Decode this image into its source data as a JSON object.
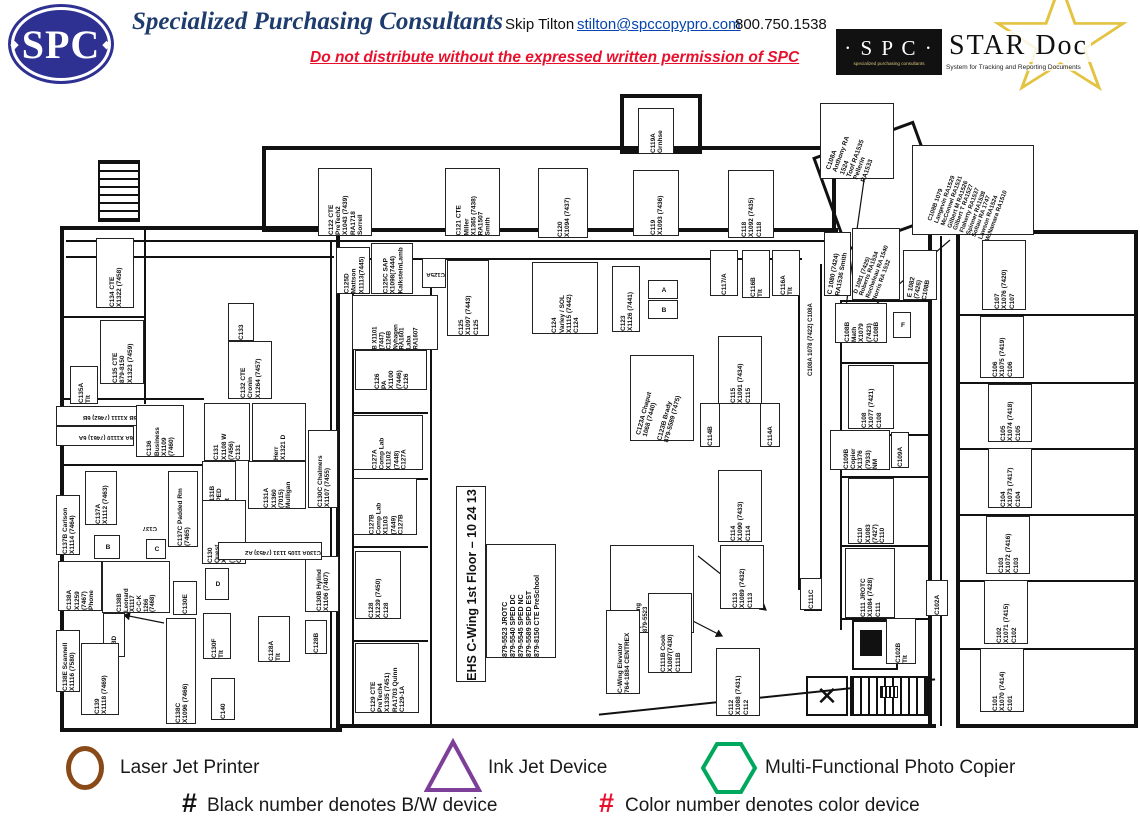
{
  "header": {
    "logo": "SPC",
    "company": "Specialized Purchasing Consultants",
    "contact": "Skip Tilton",
    "email": "stilton@spccopypro.com",
    "phone": "800.750.1538",
    "notice": "Do not distribute without the expressed written permission of SPC",
    "stardoc": {
      "box": "· S P C ·",
      "box_sub": "specialized purchasing consultants",
      "name": "STAR Doc",
      "tagline": "System for Tracking and Reporting Documents"
    }
  },
  "plan": {
    "title": "EHS C-Wing 1st Floor – 10 24 13",
    "phones": "879-5523  JROTC\n879-5540  SPED DC\n879-5545  SPED NC\n879-5589  SPED EST\n879-8150  CTE PreSchool",
    "rooms": [
      {
        "id": "C122",
        "l": "C122 CTE\nPreTech2\nX1043 (7439)\nRA1718\nSorrell",
        "x": 318,
        "y": 168,
        "w": 54,
        "h": 68
      },
      {
        "id": "C121",
        "l": "C121 CTE\nMiller\nX1365 (7438)\nRA1507\nSmith",
        "x": 445,
        "y": 168,
        "w": 55,
        "h": 68
      },
      {
        "id": "C120",
        "l": "C120\nX1094 (7437)",
        "x": 538,
        "y": 168,
        "w": 50,
        "h": 70
      },
      {
        "id": "C119",
        "l": "C119\nX1093 (7436)",
        "x": 633,
        "y": 170,
        "w": 46,
        "h": 66
      },
      {
        "id": "C119A",
        "l": "C119A\nGrnhse",
        "x": 638,
        "y": 108,
        "w": 36,
        "h": 46
      },
      {
        "id": "C118",
        "l": "C118\nX1092 (7435)\nC118",
        "x": 728,
        "y": 170,
        "w": 46,
        "h": 68
      },
      {
        "id": "C125D",
        "l": "C125D\nMattson\nX1113(7445)",
        "x": 336,
        "y": 247,
        "w": 34,
        "h": 47
      },
      {
        "id": "C125C",
        "l": "C125C SAP\nX1098(7444)\nKalksteinLamb",
        "x": 371,
        "y": 243,
        "w": 42,
        "h": 51
      },
      {
        "id": "C125A",
        "l": "C125A",
        "x": 422,
        "y": 258,
        "w": 24,
        "h": 30,
        "r": 180,
        "fs": 6
      },
      {
        "id": "C125",
        "l": "C125\nX1097 (7443)\nC125",
        "x": 447,
        "y": 260,
        "w": 42,
        "h": 76
      },
      {
        "id": "C124",
        "l": "C124\nVarley / SOL\nX1115 (7442)\nC124",
        "x": 532,
        "y": 262,
        "w": 66,
        "h": 72
      },
      {
        "id": "C123",
        "l": "C123\nX1126 (7441)",
        "x": 612,
        "y": 266,
        "w": 28,
        "h": 66
      },
      {
        "id": "boxA",
        "l": "A",
        "x": 648,
        "y": 280,
        "w": 30,
        "h": 19,
        "r": 0
      },
      {
        "id": "boxB",
        "l": "B",
        "x": 648,
        "y": 300,
        "w": 30,
        "h": 19,
        "r": 0
      },
      {
        "id": "C117A",
        "l": "C117/A",
        "x": 710,
        "y": 250,
        "w": 28,
        "h": 46
      },
      {
        "id": "C116B",
        "l": "C116B\nTlt",
        "x": 742,
        "y": 250,
        "w": 28,
        "h": 48
      },
      {
        "id": "C116A",
        "l": "C116A\nTlt",
        "x": 772,
        "y": 250,
        "w": 28,
        "h": 46
      },
      {
        "id": "C108A-box",
        "l": "C108A\nAnthony RA\n1524\nToof RA1535\nPellerin\nRA1533",
        "x": 820,
        "y": 103,
        "w": 74,
        "h": 76,
        "r": -70
      },
      {
        "id": "C108B-list",
        "l": "C108B 1079\nLangevin RA1529\nMcConnel RA1531\nGilbert M RA1526\nGilbert T RA1527\nFlaherty RA1537\nSpinner RA1538\nSoltau RA 1747\nLawson RA1524\nMcNamara RA1510",
        "x": 912,
        "y": 145,
        "w": 122,
        "h": 90,
        "r": -70,
        "fs": 6
      },
      {
        "id": "C-1080",
        "l": "C 1080 (7424)\nRA1536 Smith",
        "x": 824,
        "y": 232,
        "w": 27,
        "h": 64,
        "r": -80
      },
      {
        "id": "D-1081",
        "l": "D 1081 (7425)\nRoberts RA1534\nRocheleau RA 1540\nNorris RA 1532",
        "x": 852,
        "y": 228,
        "w": 48,
        "h": 72,
        "r": -70,
        "fs": 6
      },
      {
        "id": "E-1082",
        "l": "E 1082\n(7426)\nC108B",
        "x": 903,
        "y": 250,
        "w": 34,
        "h": 50,
        "r": -80
      },
      {
        "id": "C108B-Math",
        "l": "C108B\nMath\nX1079\n(7423)\nC108B",
        "x": 835,
        "y": 303,
        "w": 52,
        "h": 40
      },
      {
        "id": "C108A-wall",
        "l": "C108A 1078 (7422) C108A",
        "x": 804,
        "y": 276,
        "w": 14,
        "h": 102,
        "nb": true,
        "fs": 6
      },
      {
        "id": "boxF",
        "l": "F",
        "x": 893,
        "y": 312,
        "w": 18,
        "h": 26,
        "r": 0
      },
      {
        "id": "C108",
        "l": "C108\nX1077 (7421)\nC108",
        "x": 848,
        "y": 365,
        "w": 46,
        "h": 64
      },
      {
        "id": "C109B",
        "l": "C109B\nCopier\nX1376\n(7933)\nNM",
        "x": 830,
        "y": 430,
        "w": 60,
        "h": 40
      },
      {
        "id": "C109A",
        "l": "C109A",
        "x": 891,
        "y": 432,
        "w": 18,
        "h": 36
      },
      {
        "id": "C110",
        "l": "C110\nX1083\n(7427)\nC110",
        "x": 848,
        "y": 478,
        "w": 46,
        "h": 66
      },
      {
        "id": "C111",
        "l": "C111 JROTC\nX1084 (7428)\nC111",
        "x": 845,
        "y": 548,
        "w": 50,
        "h": 70
      },
      {
        "id": "C111C",
        "l": "C111C",
        "x": 800,
        "y": 578,
        "w": 22,
        "h": 32
      },
      {
        "id": "C102A",
        "l": "C102A",
        "x": 926,
        "y": 580,
        "w": 22,
        "h": 36
      },
      {
        "id": "C102B",
        "l": "C102B\nTlt",
        "x": 886,
        "y": 618,
        "w": 30,
        "h": 46
      },
      {
        "id": "C112",
        "l": "C112\nX1088 (7431)\nC112",
        "x": 716,
        "y": 648,
        "w": 44,
        "h": 68
      },
      {
        "id": "C113",
        "l": "C113\nX1089 (7432)\nC113",
        "x": 720,
        "y": 545,
        "w": 44,
        "h": 64
      },
      {
        "id": "C114",
        "l": "C114\nX1090 (7433)\nC114",
        "x": 718,
        "y": 470,
        "w": 44,
        "h": 72
      },
      {
        "id": "C115",
        "l": "C115\nX1091 (7434)\nC115",
        "x": 718,
        "y": 336,
        "w": 44,
        "h": 68
      },
      {
        "id": "C114B",
        "l": "C114B",
        "x": 700,
        "y": 403,
        "w": 20,
        "h": 44
      },
      {
        "id": "C114A",
        "l": "C114A",
        "x": 760,
        "y": 403,
        "w": 20,
        "h": 44
      },
      {
        "id": "C123AB",
        "l": "C123A Chaput\n1068 (7440)\n\nC123B Brady\n879-5589 (7475)",
        "x": 630,
        "y": 355,
        "w": 64,
        "h": 86,
        "r": -75
      },
      {
        "id": "C111A",
        "l": "C111A\nSpaulding\n879-5523\nC111-1A\nStu Phone\n1086 (7429)\nC111A-2A",
        "x": 610,
        "y": 545,
        "w": 84,
        "h": 88,
        "fs": 6
      },
      {
        "id": "C111B",
        "l": "C111B Cook\nX1087(7430)\nC111B",
        "x": 648,
        "y": 593,
        "w": 44,
        "h": 80
      },
      {
        "id": "elevator",
        "l": "C-Wing Elevator\n764-1884 CENTREX",
        "x": 606,
        "y": 610,
        "w": 34,
        "h": 84
      },
      {
        "id": "title",
        "l": "EHS C-Wing 1st Floor – 10 24 13",
        "x": 456,
        "y": 486,
        "w": 30,
        "h": 196,
        "cls": "title"
      },
      {
        "id": "phones",
        "l": "879-5523  JROTC\n879-5540  SPED DC\n879-5545  SPED NC\n879-5589  SPED EST\n879-8150  CTE PreSchool",
        "x": 486,
        "y": 544,
        "w": 70,
        "h": 114,
        "fs": 7
      },
      {
        "id": "C126B",
        "l": "B X1101\n(7447)\nC126B\nNyhagen\nRA1601\nLaba\nRA1607",
        "x": 352,
        "y": 295,
        "w": 86,
        "h": 55,
        "fs": 6
      },
      {
        "id": "C126",
        "l": "C126\nPA\nX1100\n(7446)\nC126",
        "x": 355,
        "y": 350,
        "w": 72,
        "h": 40
      },
      {
        "id": "C127A",
        "l": "C127A\nComp Lab\nX1102\n(7448)\nC127A",
        "x": 353,
        "y": 415,
        "w": 70,
        "h": 55
      },
      {
        "id": "C127B",
        "l": "C127B\nComp Lab\nX1103\n(7449)\nC127B",
        "x": 353,
        "y": 478,
        "w": 64,
        "h": 57
      },
      {
        "id": "C128",
        "l": "C128\nX1239 (7450)\nC128",
        "x": 355,
        "y": 551,
        "w": 46,
        "h": 68
      },
      {
        "id": "C129",
        "l": "C129 CTE\nPreTech4\nX1335 (7451)\nRA1703 Quinn\nC129-1A",
        "x": 355,
        "y": 643,
        "w": 64,
        "h": 70
      },
      {
        "id": "C130B",
        "l": "C130B  Hylind\nX1106 (7407)",
        "x": 305,
        "y": 556,
        "w": 34,
        "h": 56
      },
      {
        "id": "C128B",
        "l": "C128B",
        "x": 305,
        "y": 620,
        "w": 22,
        "h": 34
      },
      {
        "id": "C128A",
        "l": "C128A\nTlt",
        "x": 258,
        "y": 616,
        "w": 32,
        "h": 46
      },
      {
        "id": "C133",
        "l": "C133",
        "x": 228,
        "y": 303,
        "w": 26,
        "h": 38
      },
      {
        "id": "C132",
        "l": "C132 CTE\nCronin\nX1264 (7457)",
        "x": 228,
        "y": 341,
        "w": 44,
        "h": 58
      },
      {
        "id": "C131",
        "l": "C131\nX1108 W\n(7456)\nC131",
        "x": 204,
        "y": 403,
        "w": 46,
        "h": 58
      },
      {
        "id": "C131-Herr",
        "l": "Herr\nX1321 D",
        "x": 252,
        "y": 403,
        "w": 54,
        "h": 58
      },
      {
        "id": "C131B",
        "l": "C131B\nSPED\nTlt",
        "x": 202,
        "y": 461,
        "w": 34,
        "h": 46
      },
      {
        "id": "C131A",
        "l": "C131A\nX1360\n(7015)\nMulligan",
        "x": 248,
        "y": 461,
        "w": 58,
        "h": 48
      },
      {
        "id": "C130",
        "l": "C130\nQuest\nX1104\n(7452)\nC130",
        "x": 202,
        "y": 500,
        "w": 44,
        "h": 64
      },
      {
        "id": "C130C",
        "l": "C130C Chalmers\nX1107 (7455)",
        "x": 308,
        "y": 430,
        "w": 30,
        "h": 78
      },
      {
        "id": "C130A",
        "l": "C130A 1105 1131 (7453) A2",
        "x": 218,
        "y": 542,
        "w": 104,
        "h": 18,
        "r": 180,
        "fs": 6
      },
      {
        "id": "C134",
        "l": "C134 CTE\nX1322 (7458)",
        "x": 96,
        "y": 238,
        "w": 38,
        "h": 70
      },
      {
        "id": "C135",
        "l": "C135 CTE\n879-8150\nX1323 (7459)",
        "x": 100,
        "y": 320,
        "w": 44,
        "h": 64
      },
      {
        "id": "C135A",
        "l": "C135A\nTlt",
        "x": 70,
        "y": 366,
        "w": 28,
        "h": 38
      },
      {
        "id": "6B",
        "l": "6B X1111 (7462) 6B",
        "x": 56,
        "y": 406,
        "w": 82,
        "h": 20,
        "r": 180,
        "fs": 6
      },
      {
        "id": "6A",
        "l": "6A X1110 (7461) 6A",
        "x": 56,
        "y": 426,
        "w": 78,
        "h": 20,
        "r": 180,
        "fs": 6
      },
      {
        "id": "C136",
        "l": "C136\nBusiness\nX1109\n(7460)",
        "x": 136,
        "y": 405,
        "w": 48,
        "h": 52
      },
      {
        "id": "C137A",
        "l": "C137A\nX1112 (7463)",
        "x": 85,
        "y": 471,
        "w": 32,
        "h": 54
      },
      {
        "id": "C137B",
        "l": "C137B Carlson\nX1114 (7464)",
        "x": 56,
        "y": 495,
        "w": 24,
        "h": 60
      },
      {
        "id": "C137",
        "l": "C137",
        "x": 125,
        "y": 520,
        "w": 34,
        "h": 16,
        "r": 180,
        "fs": 6,
        "nb": true
      },
      {
        "id": "C137C",
        "l": "C137C Padded Rm\n(7465)",
        "x": 168,
        "y": 471,
        "w": 30,
        "h": 76
      },
      {
        "id": "boxB2",
        "l": "B",
        "x": 94,
        "y": 535,
        "w": 26,
        "h": 24,
        "r": 0
      },
      {
        "id": "boxC",
        "l": "C",
        "x": 146,
        "y": 539,
        "w": 20,
        "h": 20,
        "r": 0
      },
      {
        "id": "C138A",
        "l": "C138A\nX1259\n(7467)\nPhone",
        "x": 58,
        "y": 561,
        "w": 44,
        "h": 50
      },
      {
        "id": "C138B",
        "l": "C138B\nLeonard\nX1117\nC-C-K\n1266\n(7468)",
        "x": 102,
        "y": 561,
        "w": 68,
        "h": 52,
        "fs": 6
      },
      {
        "id": "C130E",
        "l": "C130E",
        "x": 173,
        "y": 581,
        "w": 24,
        "h": 34
      },
      {
        "id": "boxD",
        "l": "D",
        "x": 205,
        "y": 568,
        "w": 24,
        "h": 32,
        "r": 0
      },
      {
        "id": "C138D",
        "l": "C138D",
        "x": 103,
        "y": 613,
        "w": 22,
        "h": 44
      },
      {
        "id": "C139",
        "l": "C139\nX1118 (7469)",
        "x": 81,
        "y": 643,
        "w": 38,
        "h": 72
      },
      {
        "id": "C138C",
        "l": "C138C\nX1096 (7466)",
        "x": 166,
        "y": 618,
        "w": 30,
        "h": 106
      },
      {
        "id": "C130F",
        "l": "C130F\nTlt",
        "x": 203,
        "y": 613,
        "w": 28,
        "h": 46
      },
      {
        "id": "C140",
        "l": "C140",
        "x": 211,
        "y": 678,
        "w": 24,
        "h": 42
      },
      {
        "id": "C138E",
        "l": "C138E Scannell\nX1116 (7580)",
        "x": 56,
        "y": 630,
        "w": 24,
        "h": 62
      },
      {
        "id": "C107",
        "l": "C107\nX1076 (7420)\nC107",
        "x": 982,
        "y": 240,
        "w": 44,
        "h": 70
      },
      {
        "id": "C106",
        "l": "C106\nX1075 (7419)\nC106",
        "x": 980,
        "y": 316,
        "w": 44,
        "h": 62
      },
      {
        "id": "C105",
        "l": "C105\nX1074 (7418)\nC105",
        "x": 988,
        "y": 384,
        "w": 44,
        "h": 58
      },
      {
        "id": "C104",
        "l": "C104\nX1073 (7417)\nC104",
        "x": 988,
        "y": 448,
        "w": 44,
        "h": 60
      },
      {
        "id": "C103",
        "l": "C103\nX1072 (7416)\nC103",
        "x": 986,
        "y": 516,
        "w": 44,
        "h": 58
      },
      {
        "id": "C102",
        "l": "C102\nX1071 (7415)\nC102",
        "x": 984,
        "y": 580,
        "w": 44,
        "h": 64
      },
      {
        "id": "C101",
        "l": "C101\nX1070 (7414)\nC101",
        "x": 980,
        "y": 648,
        "w": 44,
        "h": 64
      }
    ]
  },
  "legend": {
    "items": [
      {
        "shape": "ellipse",
        "label": "Laser Jet Printer",
        "color": "#8a4a17"
      },
      {
        "shape": "triangle",
        "label": "Ink Jet Device",
        "color": "#7d3f98"
      },
      {
        "shape": "hexagon",
        "label": "Multi-Functional Photo Copier",
        "color": "#00a85d"
      }
    ],
    "notes": [
      {
        "symbol": "#",
        "color": "#111111",
        "text": "Black number denotes B/W device"
      },
      {
        "symbol": "#",
        "color": "#e8112d",
        "text": "Color number denotes color device"
      }
    ]
  }
}
